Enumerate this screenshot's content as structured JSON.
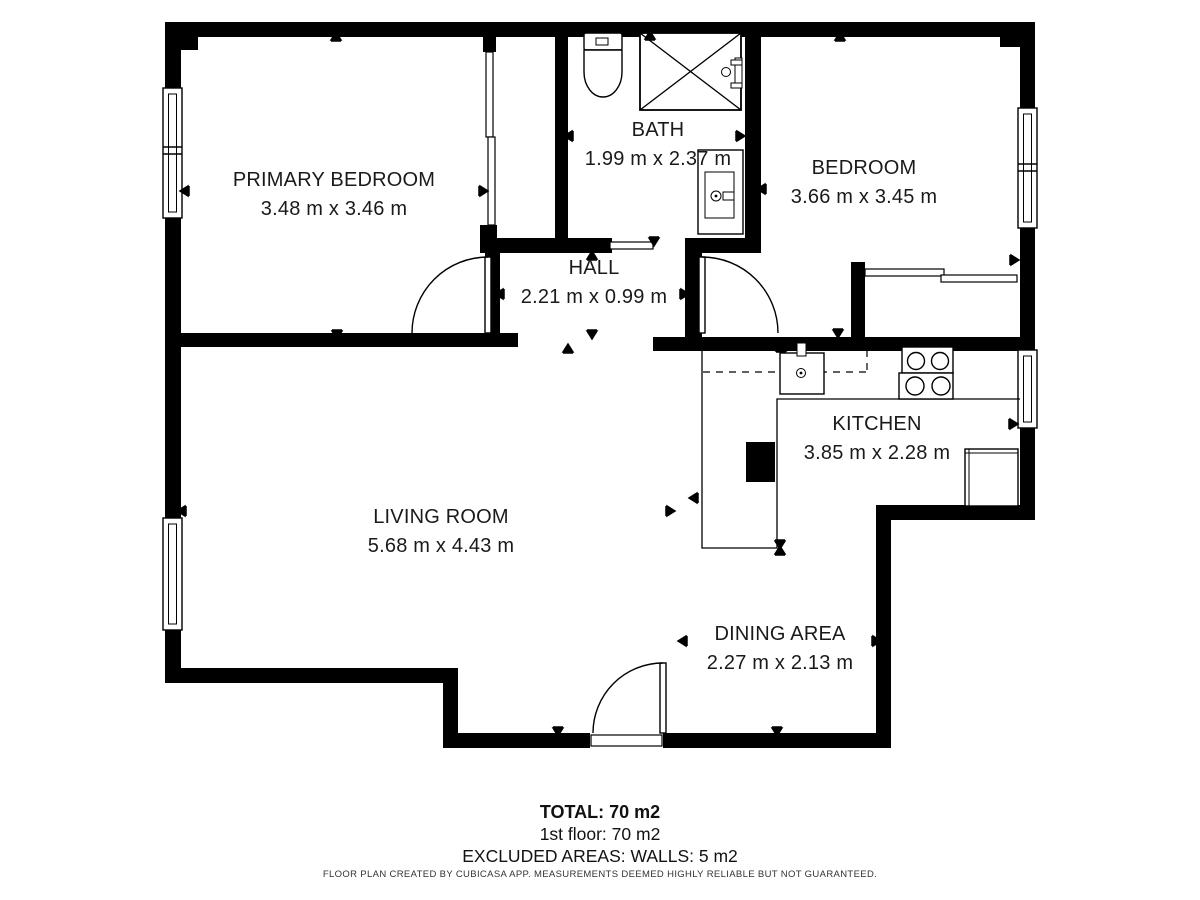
{
  "rooms": [
    {
      "name": "PRIMARY BEDROOM",
      "dims": "3.48 m x 3.46 m"
    },
    {
      "name": "BATH",
      "dims": "1.99 m x 2.37 m"
    },
    {
      "name": "BEDROOM",
      "dims": "3.66 m x 3.45 m"
    },
    {
      "name": "HALL",
      "dims": "2.21 m x 0.99 m"
    },
    {
      "name": "KITCHEN",
      "dims": "3.85 m x 2.28 m"
    },
    {
      "name": "LIVING ROOM",
      "dims": "5.68 m x 4.43 m"
    },
    {
      "name": "DINING AREA",
      "dims": "2.27 m x 2.13 m"
    }
  ],
  "summary": {
    "total": "TOTAL: 70 m2",
    "floor": "1st floor: 70 m2",
    "excluded": "EXCLUDED AREAS: WALLS: 5 m2"
  },
  "disclaimer": "FLOOR PLAN CREATED BY CUBICASA APP. MEASUREMENTS DEEMED HIGHLY RELIABLE BUT NOT GUARANTEED.",
  "colors": {
    "wall": "#000000",
    "background": "#ffffff",
    "text": "#1a1a1a"
  }
}
